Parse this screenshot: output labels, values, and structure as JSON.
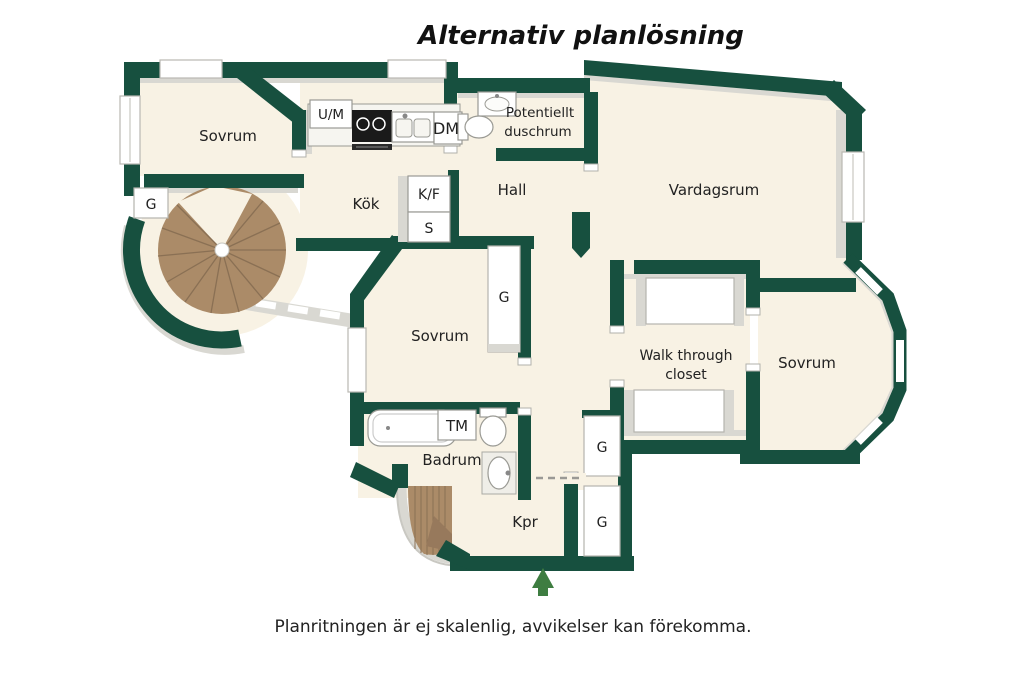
{
  "title": "Alternativ planlösning",
  "footer": "Planritningen är ej skalenlig, avvikelser kan förekomma.",
  "colors": {
    "wall_green": "#17503f",
    "floor_cream": "#f8f2e4",
    "shadow_gray": "#d9d8d2",
    "wood_brown": "#ab8b68",
    "entrance_arrow_green": "#3e7d41",
    "background": "#ffffff",
    "label_text": "#222222"
  },
  "rooms": {
    "bedroom_top_left": "Sovrum",
    "kitchen": "Kök",
    "potential_shower_line1": "Potentiellt",
    "potential_shower_line2": "duschrum",
    "hall": "Hall",
    "living_room": "Vardagsrum",
    "bedroom_middle": "Sovrum",
    "walk_through_closet_line1": "Walk through",
    "walk_through_closet_line2": "closet",
    "bedroom_right": "Sovrum",
    "bathroom": "Badrum",
    "entry_corridor": "Kpr"
  },
  "labels": {
    "washer_dryer": "U/M",
    "dishwasher": "DM",
    "fridge_freezer": "K/F",
    "pantry": "S",
    "washing_machine": "TM",
    "wardrobe_top_left": "G",
    "wardrobe_bedroom_middle": "G",
    "wardrobe_corridor_upper": "G",
    "wardrobe_corridor_lower": "G"
  }
}
